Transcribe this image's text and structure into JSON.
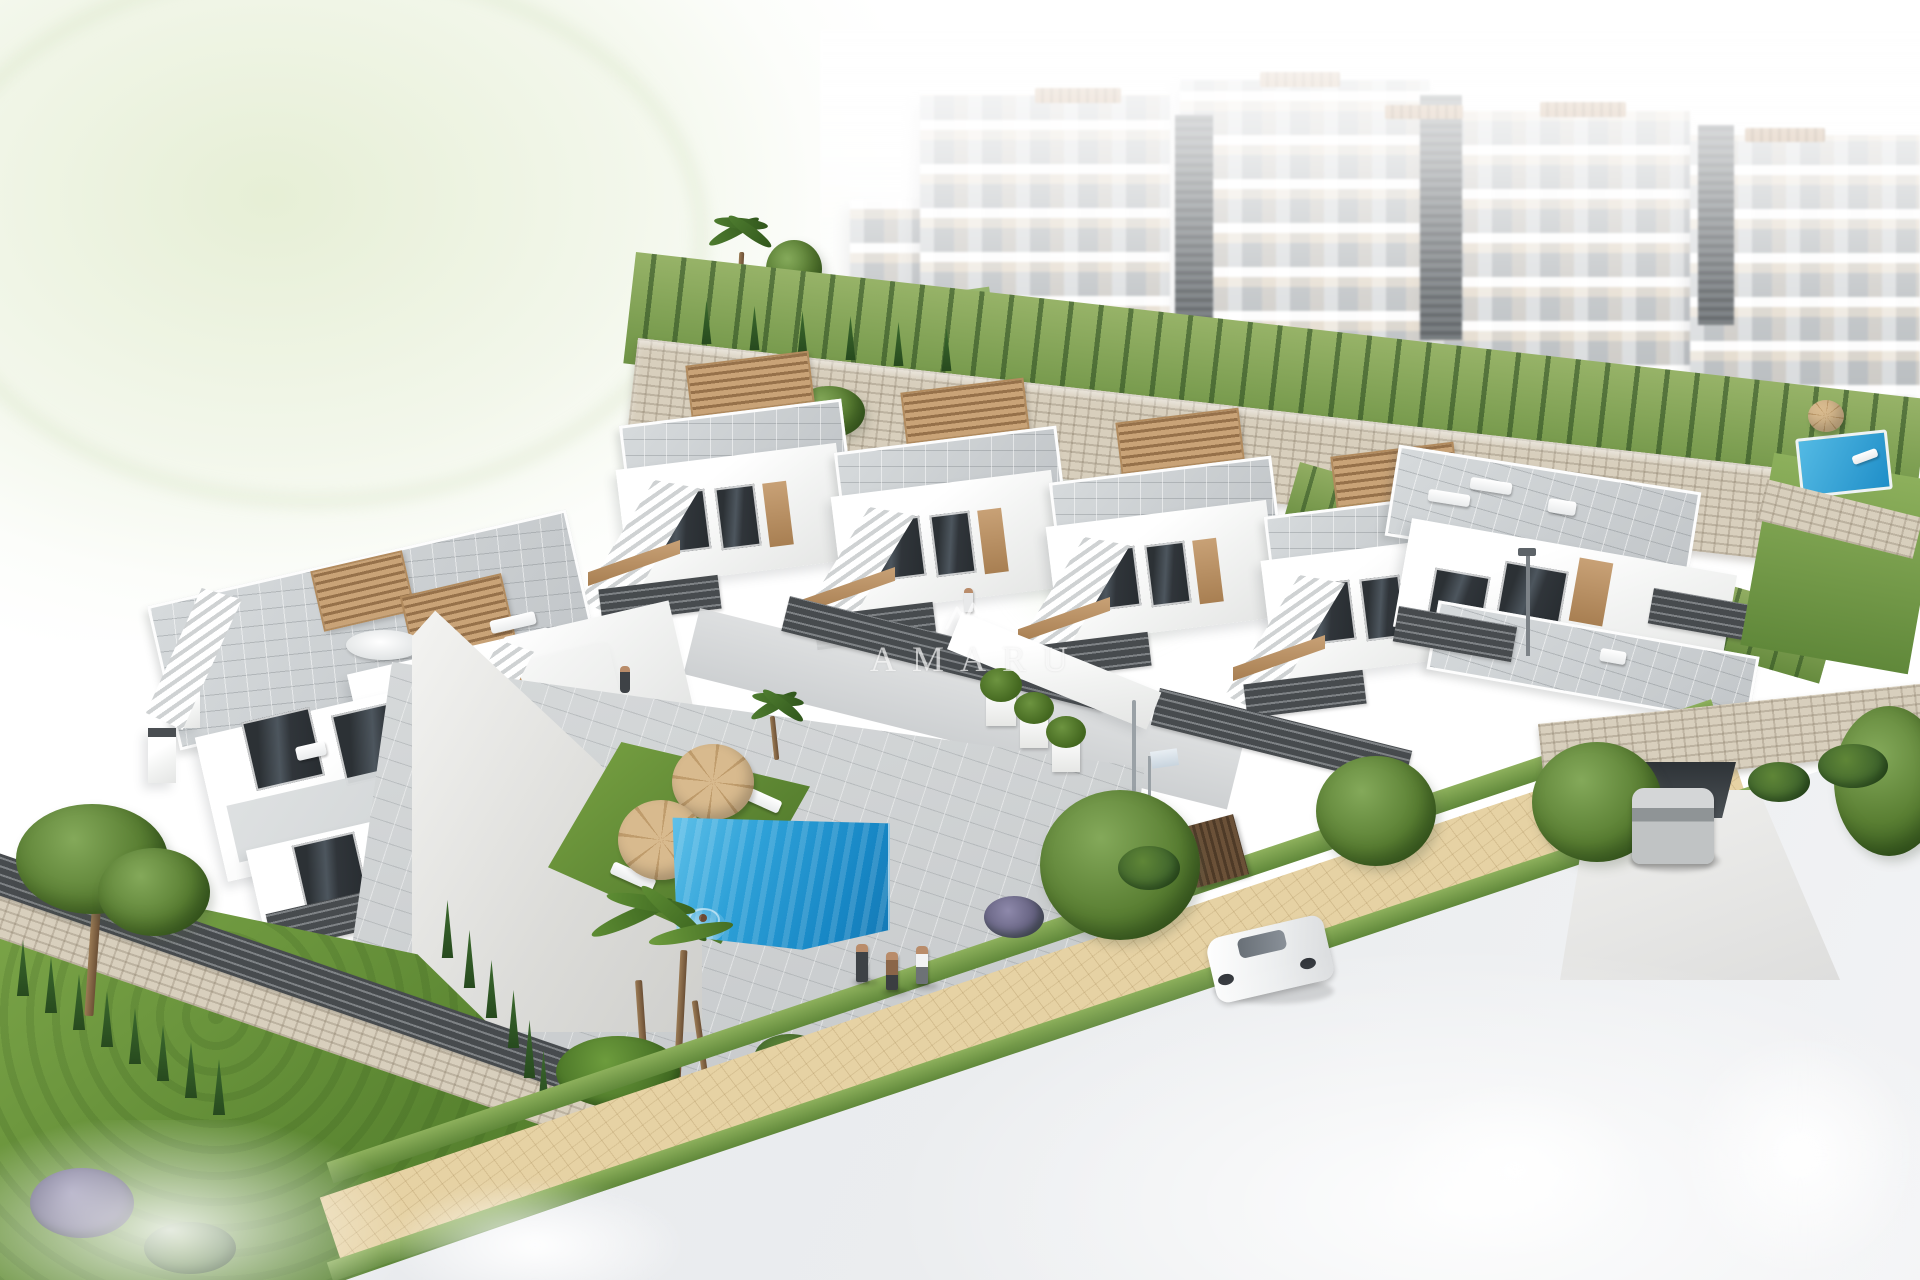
{
  "meta": {
    "domain": "Natural-Image",
    "title": "Aerial 3D architectural render of a white Mediterranean residential development",
    "description": "Bird's-eye visualisation: modern white townhouses with roof pergolas and external stairs, a communal pool with lawn sun deck, landscaped gardens, a curved street with cars, and hazy apartment blocks on the hillside behind"
  },
  "watermark": {
    "text": "AMARU",
    "logo": "amaru-logo-mark"
  },
  "palette": {
    "background": "#ffffff",
    "building_white": "#fbfbfa",
    "window_dark": "#34383c",
    "wood_tan": "#c19a6d",
    "fence_dark": "#3b3e41",
    "roof_tile": "#c9cdcf",
    "stone_beige": "#d8cfbd",
    "grass_bright": "#76a13f",
    "cypress_green": "#2e5426",
    "pool_blue": "#2fa3d9",
    "sidewalk_sand": "#e4d0a2",
    "road_grey": "#e9ebed",
    "car_grey": "#b9bcbe",
    "car_white": "#f4f5f6"
  },
  "scene": {
    "areas": [
      {
        "name": "hillside-apartments",
        "label": "hazy white apartment blocks"
      },
      {
        "name": "townhouse-row-right",
        "label": "stepped townhouse row with pergolas and stairs"
      },
      {
        "name": "townhouse-block-left",
        "label": "left townhouse block with roof terraces"
      },
      {
        "name": "communal-pool",
        "label": "blue communal swimming pool"
      },
      {
        "name": "sun-lawn",
        "label": "lawn with parasols and sun loungers"
      },
      {
        "name": "garden",
        "label": "landscaped garden with pines, palms and cypress hedges"
      },
      {
        "name": "street",
        "label": "curved street with sand-coloured sidewalk"
      }
    ],
    "counts": {
      "parasols": 3,
      "sun_loungers": 10,
      "cars": 2,
      "pedestrians": 3,
      "pools": 3
    }
  }
}
